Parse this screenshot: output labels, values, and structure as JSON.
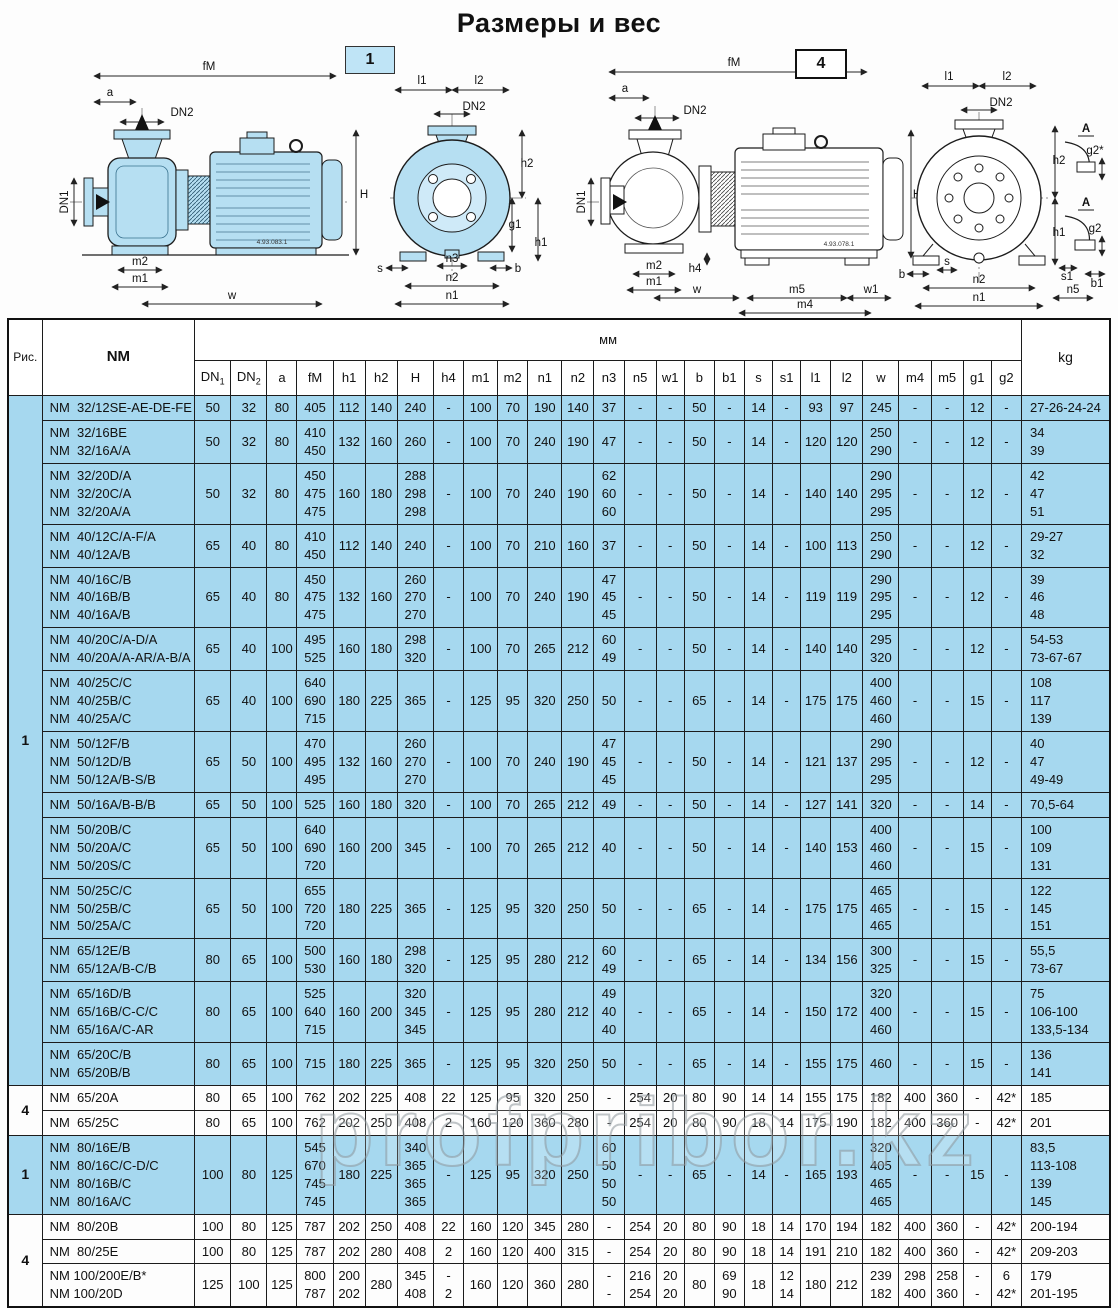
{
  "title": "Размеры и вес",
  "watermark": "profpribor.kz",
  "colors": {
    "table_blue": "#a6d8ef",
    "pump_fill": "#b6dff2",
    "line": "#1c1c1c"
  },
  "diagram1": {
    "badge": "1",
    "code": "4.93.083.1",
    "side": {
      "fM": "fM",
      "a": "a",
      "dn2": "DN2",
      "dn1": "DN1",
      "H": "H",
      "m2": "m2",
      "m1": "m1",
      "w": "w"
    },
    "front": {
      "l1": "l1",
      "l2": "l2",
      "dn2": "DN2",
      "h2": "h2",
      "g1": "g1",
      "h1": "h1",
      "s": "s",
      "n3": "n3",
      "b": "b",
      "n2": "n2",
      "n1": "n1"
    }
  },
  "diagram4": {
    "badge": "4",
    "code": "4.93.078.1",
    "side": {
      "fM": "fM",
      "a": "a",
      "dn2": "DN2",
      "dn1": "DN1",
      "H": "H",
      "h4": "h4",
      "m2": "m2",
      "m1": "m1",
      "w": "w",
      "m5": "m5",
      "w1": "w1",
      "m4": "m4"
    },
    "front": {
      "l1": "l1",
      "l2": "l2",
      "dn2": "DN2",
      "h2": "h2",
      "h1": "h1",
      "b": "b",
      "s": "s",
      "n2": "n2",
      "n1": "n1"
    },
    "details": {
      "A1": "A",
      "g2s": "g2*",
      "A2": "A",
      "g2": "g2",
      "s1": "s1",
      "b1": "b1",
      "n5": "n5"
    }
  },
  "table": {
    "fig_header": "Рис.",
    "model_header": "NM",
    "unit_header": "мм",
    "kg_header": "kg",
    "columns": [
      "DN1",
      "DN2",
      "a",
      "fM",
      "h1",
      "h2",
      "H",
      "h4",
      "m1",
      "m2",
      "n1",
      "n2",
      "n3",
      "n5",
      "w1",
      "b",
      "b1",
      "s",
      "s1",
      "l1",
      "l2",
      "w",
      "m4",
      "m5",
      "g1",
      "g2"
    ],
    "groups": [
      {
        "fig": "1",
        "shaded": true,
        "rows": [
          {
            "model": "NM  32/12SE-AE-DE-FE",
            "values": [
              "50",
              "32",
              "80",
              "405",
              "112",
              "140",
              "240",
              "-",
              "100",
              "70",
              "190",
              "140",
              "37",
              "-",
              "-",
              "50",
              "-",
              "14",
              "-",
              "93",
              "97",
              "245",
              "-",
              "-",
              "12",
              "-"
            ],
            "kg": "27-26-24-24"
          },
          {
            "model": "NM  32/16BE\nNM  32/16A/A",
            "values": [
              "50",
              "32",
              "80",
              "410\n450",
              "132",
              "160",
              "260",
              "-",
              "100",
              "70",
              "240",
              "190",
              "47",
              "-",
              "-",
              "50",
              "-",
              "14",
              "-",
              "120",
              "120",
              "250\n290",
              "-",
              "-",
              "12",
              "-"
            ],
            "kg": "34\n39"
          },
          {
            "model": "NM  32/20D/A\nNM  32/20C/A\nNM  32/20A/A",
            "values": [
              "50",
              "32",
              "80",
              "450\n475\n475",
              "160",
              "180",
              "288\n298\n298",
              "-",
              "100",
              "70",
              "240",
              "190",
              "62\n60\n60",
              "-",
              "-",
              "50",
              "-",
              "14",
              "-",
              "140",
              "140",
              "290\n295\n295",
              "-",
              "-",
              "12",
              "-"
            ],
            "kg": "42\n47\n51"
          },
          {
            "model": "NM  40/12C/A-F/A\nNM  40/12A/B",
            "values": [
              "65",
              "40",
              "80",
              "410\n450",
              "112",
              "140",
              "240",
              "-",
              "100",
              "70",
              "210",
              "160",
              "37",
              "-",
              "-",
              "50",
              "-",
              "14",
              "-",
              "100",
              "113",
              "250\n290",
              "-",
              "-",
              "12",
              "-"
            ],
            "kg": "29-27\n32"
          },
          {
            "model": "NM  40/16C/B\nNM  40/16B/B\nNM  40/16A/B",
            "values": [
              "65",
              "40",
              "80",
              "450\n475\n475",
              "132",
              "160",
              "260\n270\n270",
              "-",
              "100",
              "70",
              "240",
              "190",
              "47\n45\n45",
              "-",
              "-",
              "50",
              "-",
              "14",
              "-",
              "119",
              "119",
              "290\n295\n295",
              "-",
              "-",
              "12",
              "-"
            ],
            "kg": "39\n46\n48"
          },
          {
            "model": "NM  40/20C/A-D/A\nNM  40/20A/A-AR/A-B/A",
            "values": [
              "65",
              "40",
              "100",
              "495\n525",
              "160",
              "180",
              "298\n320",
              "-",
              "100",
              "70",
              "265",
              "212",
              "60\n49",
              "-",
              "-",
              "50",
              "-",
              "14",
              "-",
              "140",
              "140",
              "295\n320",
              "-",
              "-",
              "12",
              "-"
            ],
            "kg": "54-53\n73-67-67"
          },
          {
            "model": "NM  40/25C/C\nNM  40/25B/C\nNM  40/25A/C",
            "values": [
              "65",
              "40",
              "100",
              "640\n690\n715",
              "180",
              "225",
              "365",
              "-",
              "125",
              "95",
              "320",
              "250",
              "50",
              "-",
              "-",
              "65",
              "-",
              "14",
              "-",
              "175",
              "175",
              "400\n460\n460",
              "-",
              "-",
              "15",
              "-"
            ],
            "kg": "108\n117\n139"
          },
          {
            "model": "NM  50/12F/B\nNM  50/12D/B\nNM  50/12A/B-S/B",
            "values": [
              "65",
              "50",
              "100",
              "470\n495\n495",
              "132",
              "160",
              "260\n270\n270",
              "-",
              "100",
              "70",
              "240",
              "190",
              "47\n45\n45",
              "-",
              "-",
              "50",
              "-",
              "14",
              "-",
              "121",
              "137",
              "290\n295\n295",
              "-",
              "-",
              "12",
              "-"
            ],
            "kg": "40\n47\n49-49"
          },
          {
            "model": "NM  50/16A/B-B/B",
            "values": [
              "65",
              "50",
              "100",
              "525",
              "160",
              "180",
              "320",
              "-",
              "100",
              "70",
              "265",
              "212",
              "49",
              "-",
              "-",
              "50",
              "-",
              "14",
              "-",
              "127",
              "141",
              "320",
              "-",
              "-",
              "14",
              "-"
            ],
            "kg": "70,5-64"
          },
          {
            "model": "NM  50/20B/C\nNM  50/20A/C\nNM  50/20S/C",
            "values": [
              "65",
              "50",
              "100",
              "640\n690\n720",
              "160",
              "200",
              "345",
              "-",
              "100",
              "70",
              "265",
              "212",
              "40",
              "-",
              "-",
              "50",
              "-",
              "14",
              "-",
              "140",
              "153",
              "400\n460\n460",
              "-",
              "-",
              "15",
              "-"
            ],
            "kg": "100\n109\n131"
          },
          {
            "model": "NM  50/25C/C\nNM  50/25B/C\nNM  50/25A/C",
            "values": [
              "65",
              "50",
              "100",
              "655\n720\n720",
              "180",
              "225",
              "365",
              "-",
              "125",
              "95",
              "320",
              "250",
              "50",
              "-",
              "-",
              "65",
              "-",
              "14",
              "-",
              "175",
              "175",
              "465\n465\n465",
              "-",
              "-",
              "15",
              "-"
            ],
            "kg": "122\n145\n151"
          },
          {
            "model": "NM  65/12E/B\nNM  65/12A/B-C/B",
            "values": [
              "80",
              "65",
              "100",
              "500\n530",
              "160",
              "180",
              "298\n320",
              "-",
              "125",
              "95",
              "280",
              "212",
              "60\n49",
              "-",
              "-",
              "65",
              "-",
              "14",
              "-",
              "134",
              "156",
              "300\n325",
              "-",
              "-",
              "15",
              "-"
            ],
            "kg": "55,5\n73-67"
          },
          {
            "model": "NM  65/16D/B\nNM  65/16B/C-C/C\nNM  65/16A/C-AR",
            "values": [
              "80",
              "65",
              "100",
              "525\n640\n715",
              "160",
              "200",
              "320\n345\n345",
              "-",
              "125",
              "95",
              "280",
              "212",
              "49\n40\n40",
              "-",
              "-",
              "65",
              "-",
              "14",
              "-",
              "150",
              "172",
              "320\n400\n460",
              "-",
              "-",
              "15",
              "-"
            ],
            "kg": "75\n106-100\n133,5-134"
          },
          {
            "model": "NM  65/20C/B\nNM  65/20B/B",
            "values": [
              "80",
              "65",
              "100",
              "715",
              "180",
              "225",
              "365",
              "-",
              "125",
              "95",
              "320",
              "250",
              "50",
              "-",
              "-",
              "65",
              "-",
              "14",
              "-",
              "155",
              "175",
              "460",
              "-",
              "-",
              "15",
              "-"
            ],
            "kg": "136\n141"
          }
        ]
      },
      {
        "fig": "4",
        "shaded": false,
        "rows": [
          {
            "model": "NM  65/20A",
            "values": [
              "80",
              "65",
              "100",
              "762",
              "202",
              "225",
              "408",
              "22",
              "125",
              "95",
              "320",
              "250",
              "-",
              "254",
              "20",
              "80",
              "90",
              "14",
              "14",
              "155",
              "175",
              "182",
              "400",
              "360",
              "-",
              "42*"
            ],
            "kg": "185"
          },
          {
            "model": "NM  65/25C",
            "values": [
              "80",
              "65",
              "100",
              "762",
              "202",
              "250",
              "408",
              "2",
              "160",
              "120",
              "360",
              "280",
              "-",
              "254",
              "20",
              "80",
              "90",
              "18",
              "14",
              "175",
              "190",
              "182",
              "400",
              "360",
              "-",
              "42*"
            ],
            "kg": "201"
          }
        ]
      },
      {
        "fig": "1",
        "shaded": true,
        "rows": [
          {
            "model": "NM  80/16E/B\nNM  80/16C/C-D/C\nNM  80/16B/C\nNM  80/16A/C",
            "values": [
              "100",
              "80",
              "125",
              "545\n670\n745\n745",
              "180",
              "225",
              "340\n365\n365\n365",
              "-",
              "125",
              "95",
              "320",
              "250",
              "60\n50\n50\n50",
              "-",
              "-",
              "65",
              "-",
              "14",
              "-",
              "165",
              "193",
              "320\n405\n465\n465",
              "-",
              "-",
              "15",
              "-"
            ],
            "kg": "83,5\n113-108\n139\n145"
          }
        ]
      },
      {
        "fig": "4",
        "shaded": false,
        "rows": [
          {
            "model": "NM  80/20B",
            "values": [
              "100",
              "80",
              "125",
              "787",
              "202",
              "250",
              "408",
              "22",
              "160",
              "120",
              "345",
              "280",
              "-",
              "254",
              "20",
              "80",
              "90",
              "18",
              "14",
              "170",
              "194",
              "182",
              "400",
              "360",
              "-",
              "42*"
            ],
            "kg": "200-194"
          },
          {
            "model": "NM  80/25E",
            "values": [
              "100",
              "80",
              "125",
              "787",
              "202",
              "280",
              "408",
              "2",
              "160",
              "120",
              "400",
              "315",
              "-",
              "254",
              "20",
              "80",
              "90",
              "18",
              "14",
              "191",
              "210",
              "182",
              "400",
              "360",
              "-",
              "42*"
            ],
            "kg": "209-203"
          },
          {
            "model": "NM 100/200E/B*\nNM 100/20D",
            "values": [
              "125",
              "100",
              "125",
              "800\n787",
              "200\n202",
              "280",
              "345\n408",
              "-\n2",
              "160",
              "120",
              "360",
              "280",
              "-\n-",
              "216\n254",
              "20\n20",
              "80",
              "69\n90",
              "18",
              "12\n14",
              "180",
              "212",
              "239\n182",
              "298\n400",
              "258\n360",
              "-\n-",
              "6\n42*"
            ],
            "kg": "179\n201-195"
          }
        ]
      }
    ]
  }
}
